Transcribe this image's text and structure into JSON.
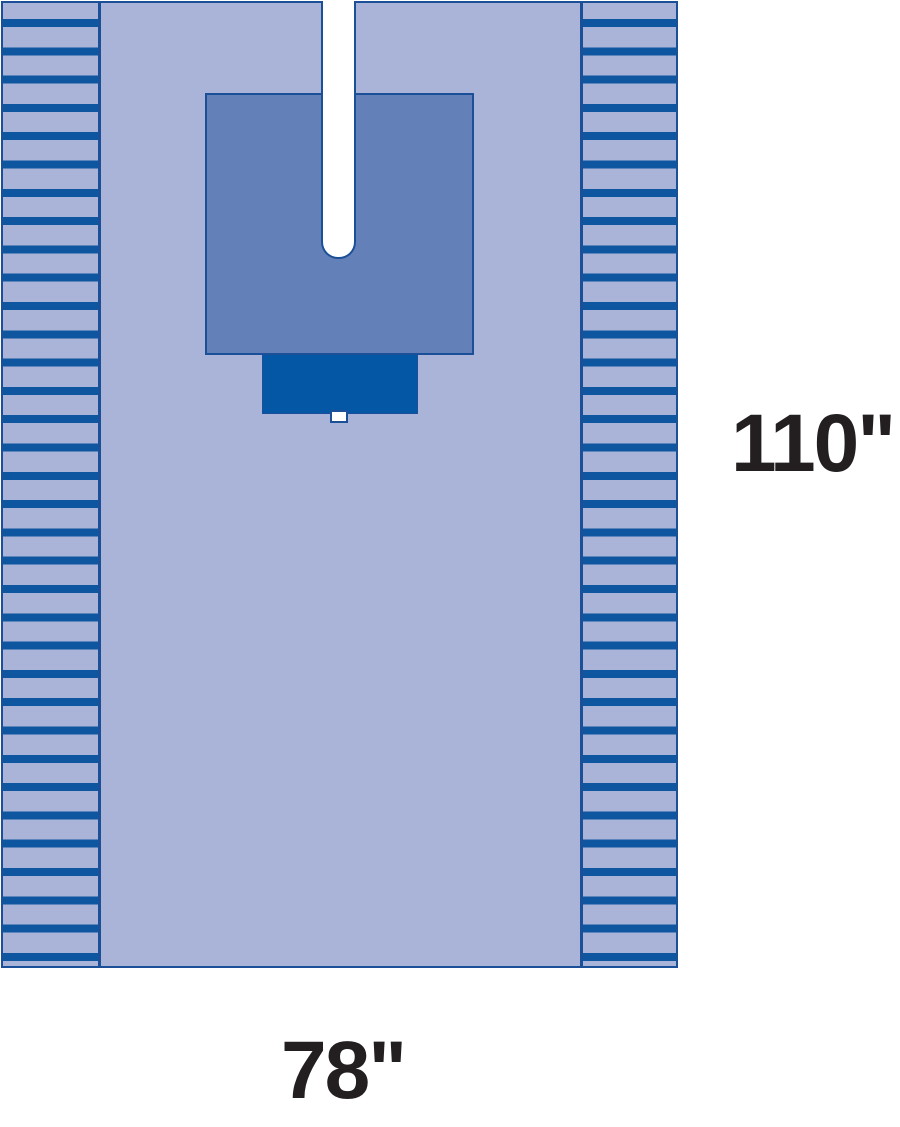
{
  "diagram": {
    "kind": "surgical-split-drape-diagram",
    "labels": {
      "height": "110\"",
      "width": "78\""
    },
    "parts": {
      "left_edge": "fanfold-pleated-edge",
      "right_edge": "fanfold-pleated-edge",
      "patch": "reinforcement-patch",
      "pouch": "fluid-collection-pouch",
      "slit": "split-opening",
      "tab": "tape-tab"
    },
    "colors": {
      "page_background": "#ffffff",
      "drape_body": "#a9b4d8",
      "stripe": "#0e56a0",
      "border": "#1b4f97",
      "reinforcement": "#6380b8",
      "pouch": "#0357a4",
      "slit": "#ffffff",
      "text": "#231f20"
    }
  }
}
